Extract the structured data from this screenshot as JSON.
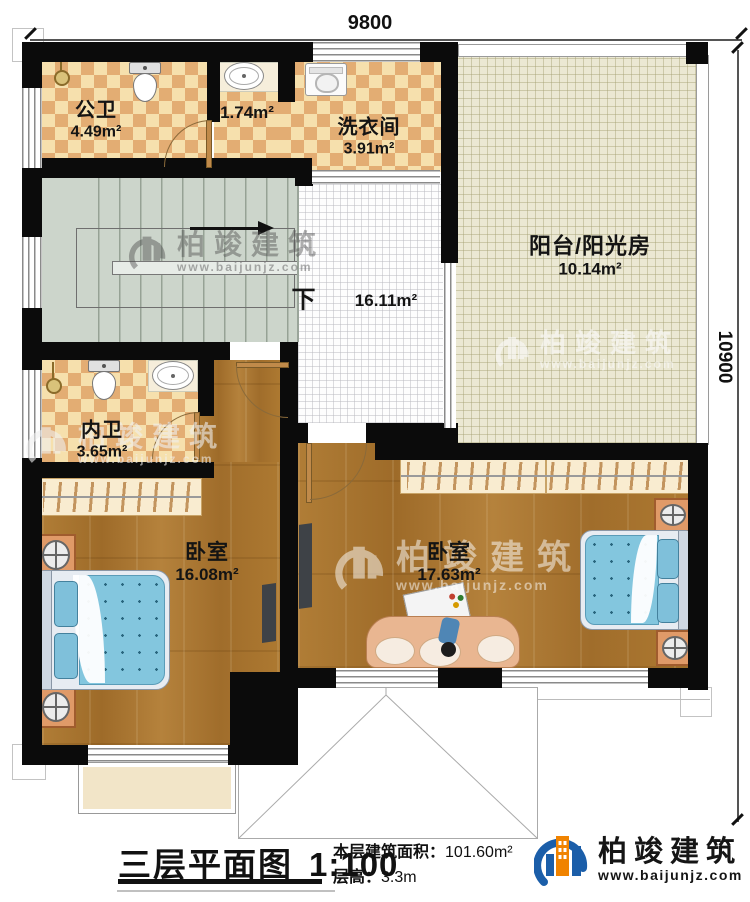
{
  "dimensions": {
    "top_width": "9800",
    "right_height": "10900"
  },
  "rooms": {
    "public_bath": {
      "name": "公卫",
      "area": "4.49m²"
    },
    "vanity": {
      "area": "1.74m²"
    },
    "laundry": {
      "name": "洗衣间",
      "area": "3.91m²"
    },
    "balcony": {
      "name": "阳台/阳光房",
      "area": "10.14m²"
    },
    "hall": {
      "area": "16.11m²"
    },
    "inner_bath": {
      "name": "内卫",
      "area": "3.65m²"
    },
    "bedroom_left": {
      "name": "卧室",
      "area": "16.08m²"
    },
    "bedroom_right": {
      "name": "卧室",
      "area": "17.63m²"
    }
  },
  "stairs": {
    "down_label": "下"
  },
  "title": {
    "name": "三层平面图",
    "scale": "1:100"
  },
  "info": {
    "area_label": "本层建筑面积：",
    "area_value": "101.60m²",
    "height_label": "层高：",
    "height_value": "3.3m"
  },
  "brand": {
    "name": "柏竣建筑",
    "url": "www.baijunjz.com"
  },
  "colors": {
    "wall": "#0b0b0b",
    "bath_tile_dark": "#e3ad73",
    "bath_tile_light": "#f6e0ad",
    "wood_floor": "#a9762f",
    "balcony_floor": "#ebe8d3",
    "stairs_floor": "#ccd5cb",
    "bed_blue": "#83c6de",
    "brand_blue": "#1b5ea9",
    "brand_orange": "#f08300"
  }
}
